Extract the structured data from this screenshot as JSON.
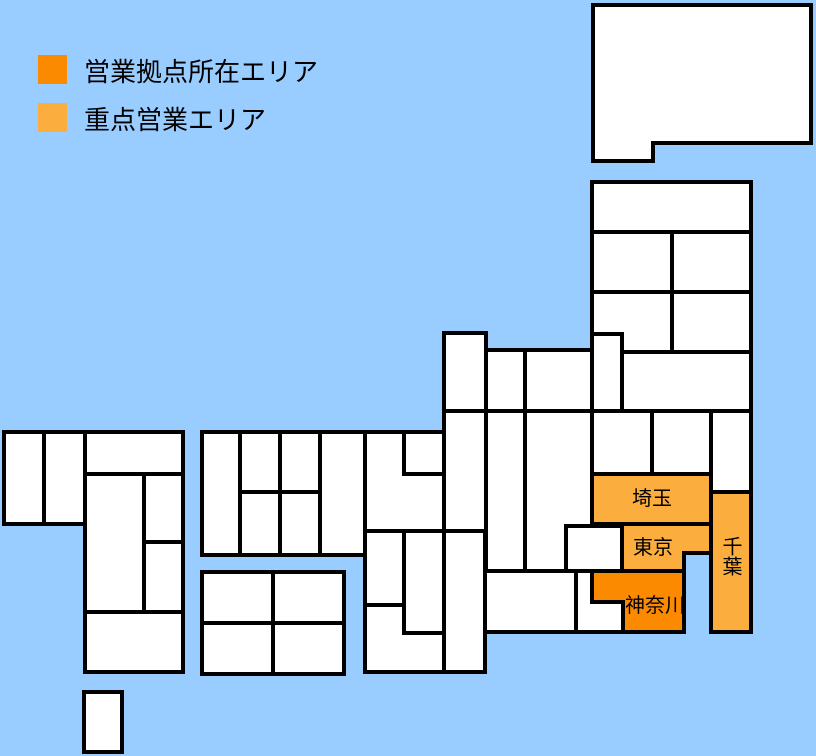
{
  "legend": {
    "items": [
      {
        "label": "営業拠点所在エリア",
        "swatch": "office",
        "color": "#FC8A00"
      },
      {
        "label": "重点営業エリア",
        "swatch": "priority",
        "color": "#FBAE3E"
      }
    ]
  },
  "colors": {
    "sea": "#99CCFF",
    "land": "#FFFFFF",
    "border": "#000000",
    "office": "#FC8A00",
    "priority": "#FBAE3E",
    "label_text": "#000000"
  },
  "map": {
    "labels": [
      {
        "text": "埼玉",
        "area_type": "priority"
      },
      {
        "text": "東京",
        "area_type": "priority"
      },
      {
        "text": "神奈川",
        "area_type": "office"
      },
      {
        "text": "千葉",
        "area_type": "priority"
      }
    ]
  }
}
